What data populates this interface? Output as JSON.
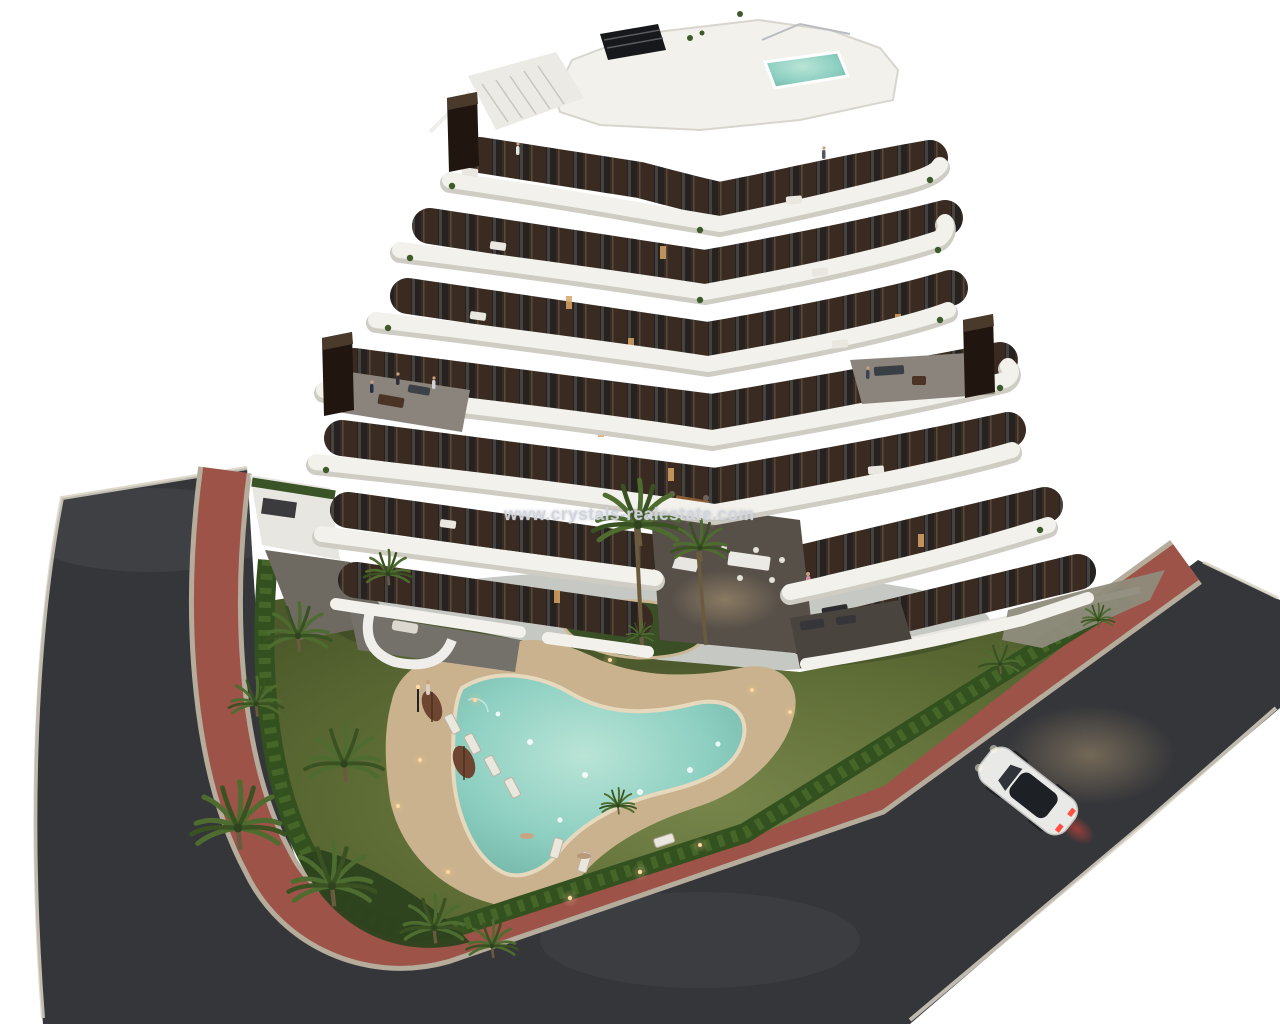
{
  "watermark": {
    "text": "www.crystals-realestate.com"
  },
  "palette": {
    "background": "#ffffff",
    "asphalt": "#35363a",
    "sidewalk_red": "#9d5348",
    "curb": "#b5ac9c",
    "lawn": "#55652f",
    "lawn_lit": "#76854a",
    "hedge": "#33501f",
    "pool_water": "#8ed0c2",
    "pool_deck": "#c9b28d",
    "building_dark": "#392b21",
    "building_white": "#f2f1ec",
    "band_shadow": "#cfccc4",
    "terrace_gray": "#8a847c",
    "courtyard_gray": "#575049",
    "concrete": "#8f8c7c",
    "palm_green": "#4f6c30",
    "palm_dark": "#3a5222",
    "trunk": "#6b5b3e",
    "umbrella": "#6e4530",
    "car_body": "#e9e9e7",
    "car_glass": "#1d2126",
    "taillight": "#ff5043",
    "warm_glow": "#e8c78f",
    "lit_window": "#d9a566"
  },
  "scene": {
    "title": "Aerial 3D render of a modern apartment complex at dusk",
    "elements": [
      "left-road",
      "bottom-road",
      "right-road",
      "perimeter-sidewalk",
      "apartment-building",
      "rooftop-terrace",
      "rooftop-pool",
      "rooftop-stairs",
      "chimneys",
      "balconies",
      "courtyard",
      "ground-terraces",
      "garden-lawn",
      "planting-island",
      "perimeter-hedge",
      "palm-trees",
      "swimming-pool",
      "pool-deck",
      "sun-loungers",
      "parasols",
      "garden-lights",
      "white-car",
      "street-glow",
      "watermark"
    ]
  }
}
